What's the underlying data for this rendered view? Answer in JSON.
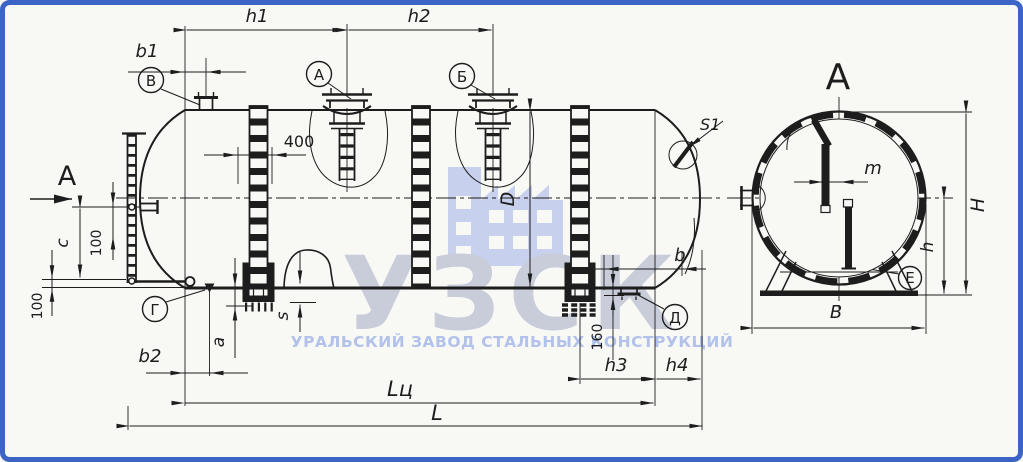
{
  "colors": {
    "frame_blue": "#3c63c6",
    "background": "#f8f8f5",
    "ink": "#1d1d1d",
    "watermark_brand": "#c8cdd9",
    "watermark_tagline": "#b2c2ea",
    "watermark_icon": "#c7d0ec"
  },
  "watermark": {
    "brand": "УЗСК",
    "tagline": "УРАЛЬСКИЙ ЗАВОД СТАЛЬНЫХ КОНСТРУКЦИЙ",
    "icon": "factory-icon"
  },
  "view_labels": {
    "section_arrow": "А",
    "end_view_title": "А"
  },
  "callouts": {
    "v": "В",
    "a": "А",
    "b": "Б",
    "g": "Г",
    "d": "Д",
    "e": "Е"
  },
  "labels": {
    "h1": "h1",
    "h2": "h2",
    "b1": "b1",
    "d400": "400",
    "c": "c",
    "c100": "100",
    "base100": "100",
    "b2": "b2",
    "a": "a",
    "s": "s",
    "lc": "Lц",
    "l": "L",
    "d160": "160",
    "h3": "h3",
    "h4": "h4",
    "b": "b",
    "dD": "D",
    "s1": "S1",
    "m": "m",
    "hbig": "H",
    "hsmall": "h",
    "bbig": "B"
  }
}
